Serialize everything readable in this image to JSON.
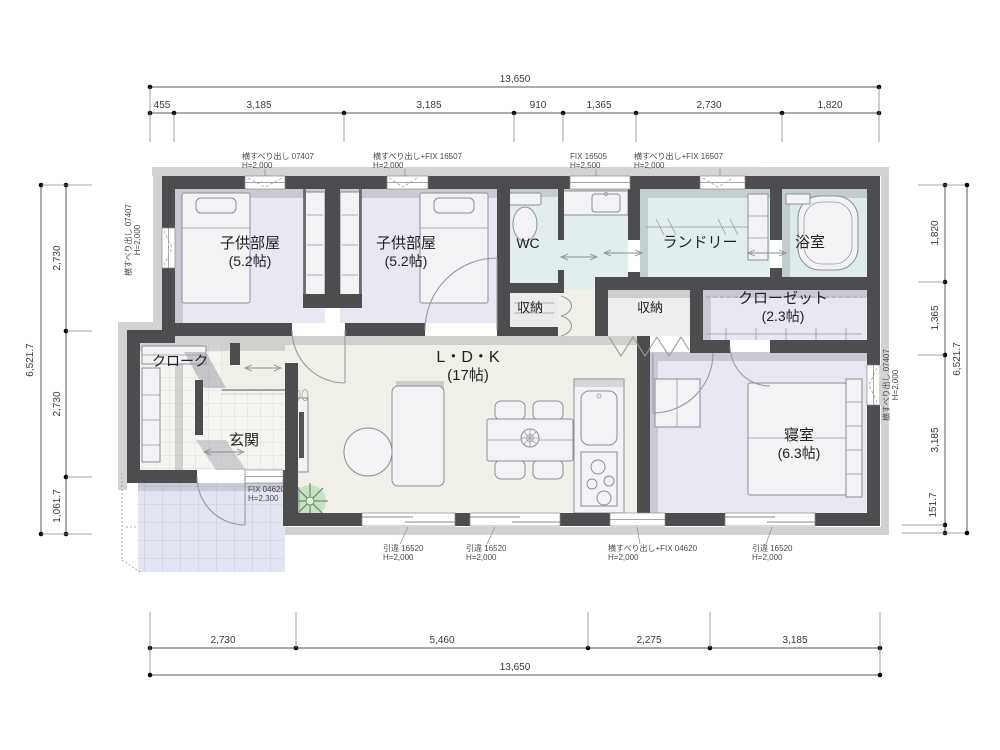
{
  "drawing": {
    "type": "floor-plan",
    "colors": {
      "wall": "#4d4d4f",
      "wet_room_floor": "#e2eeed",
      "room_floor": "#e7e8f1",
      "wood_floor": "#f1f0e8",
      "tile_floor": "#f4f4f1",
      "porch_floor": "#e4e5f2",
      "plant_green": "#b7ddb7"
    }
  },
  "rooms": {
    "child1": {
      "label": "子供部屋",
      "size": "(5.2帖)"
    },
    "child2": {
      "label": "子供部屋",
      "size": "(5.2帖)"
    },
    "wc": {
      "label": "WC"
    },
    "laundry": {
      "label": "ランドリー"
    },
    "bath": {
      "label": "浴室"
    },
    "storage1": {
      "label": "収納"
    },
    "storage2": {
      "label": "収納"
    },
    "closet": {
      "label": "クローゼット",
      "size": "(2.3帖)"
    },
    "cloak": {
      "label": "クローク"
    },
    "entrance": {
      "label": "玄関"
    },
    "ldk": {
      "label": "L・D・K",
      "size": "(17帖)"
    },
    "bedroom": {
      "label": "寝室",
      "size": "(6.3帖)"
    }
  },
  "dimensions": {
    "top": {
      "total": "13,650",
      "segments": [
        "455",
        "3,185",
        "3,185",
        "910",
        "1,365",
        "2,730",
        "1,820"
      ]
    },
    "bottom": {
      "total": "13,650",
      "segments": [
        "2,730",
        "5,460",
        "2,275",
        "3,185"
      ]
    },
    "left": {
      "total": "6,521.7",
      "segments": [
        "2,730",
        "2,730",
        "1,061.7"
      ]
    },
    "right": {
      "total": "6,521.7",
      "segments": [
        "1,820",
        "1,365",
        "3,185",
        "151.7"
      ]
    }
  },
  "openings": {
    "top_child1": {
      "name": "横すべり出し 07407",
      "height": "H=2,000"
    },
    "top_child2": {
      "name": "横すべり出し+FIX 16507",
      "height": "H=2,000"
    },
    "top_fix": {
      "name": "FIX 16505",
      "height": "H=2,500"
    },
    "top_laundry": {
      "name": "横すべり出し+FIX 16507",
      "height": "H=2,000"
    },
    "left_child1": {
      "name": "横すべり出し 07407",
      "height": "H=2,000"
    },
    "right_bedroom": {
      "name": "横すべり出し 07407",
      "height": "H=2,000"
    },
    "bottom_ldk1": {
      "name": "引違 16520",
      "height": "H=2,000"
    },
    "bottom_ldk2": {
      "name": "引違 16520",
      "height": "H=2,000"
    },
    "bottom_kitchen": {
      "name": "横すべり出し+FIX 04620",
      "height": "H=2,000"
    },
    "bottom_bedroom": {
      "name": "引違 16520",
      "height": "H=2,000"
    },
    "entrance_fix": {
      "name": "FIX 04620",
      "height": "H=2,300"
    }
  }
}
